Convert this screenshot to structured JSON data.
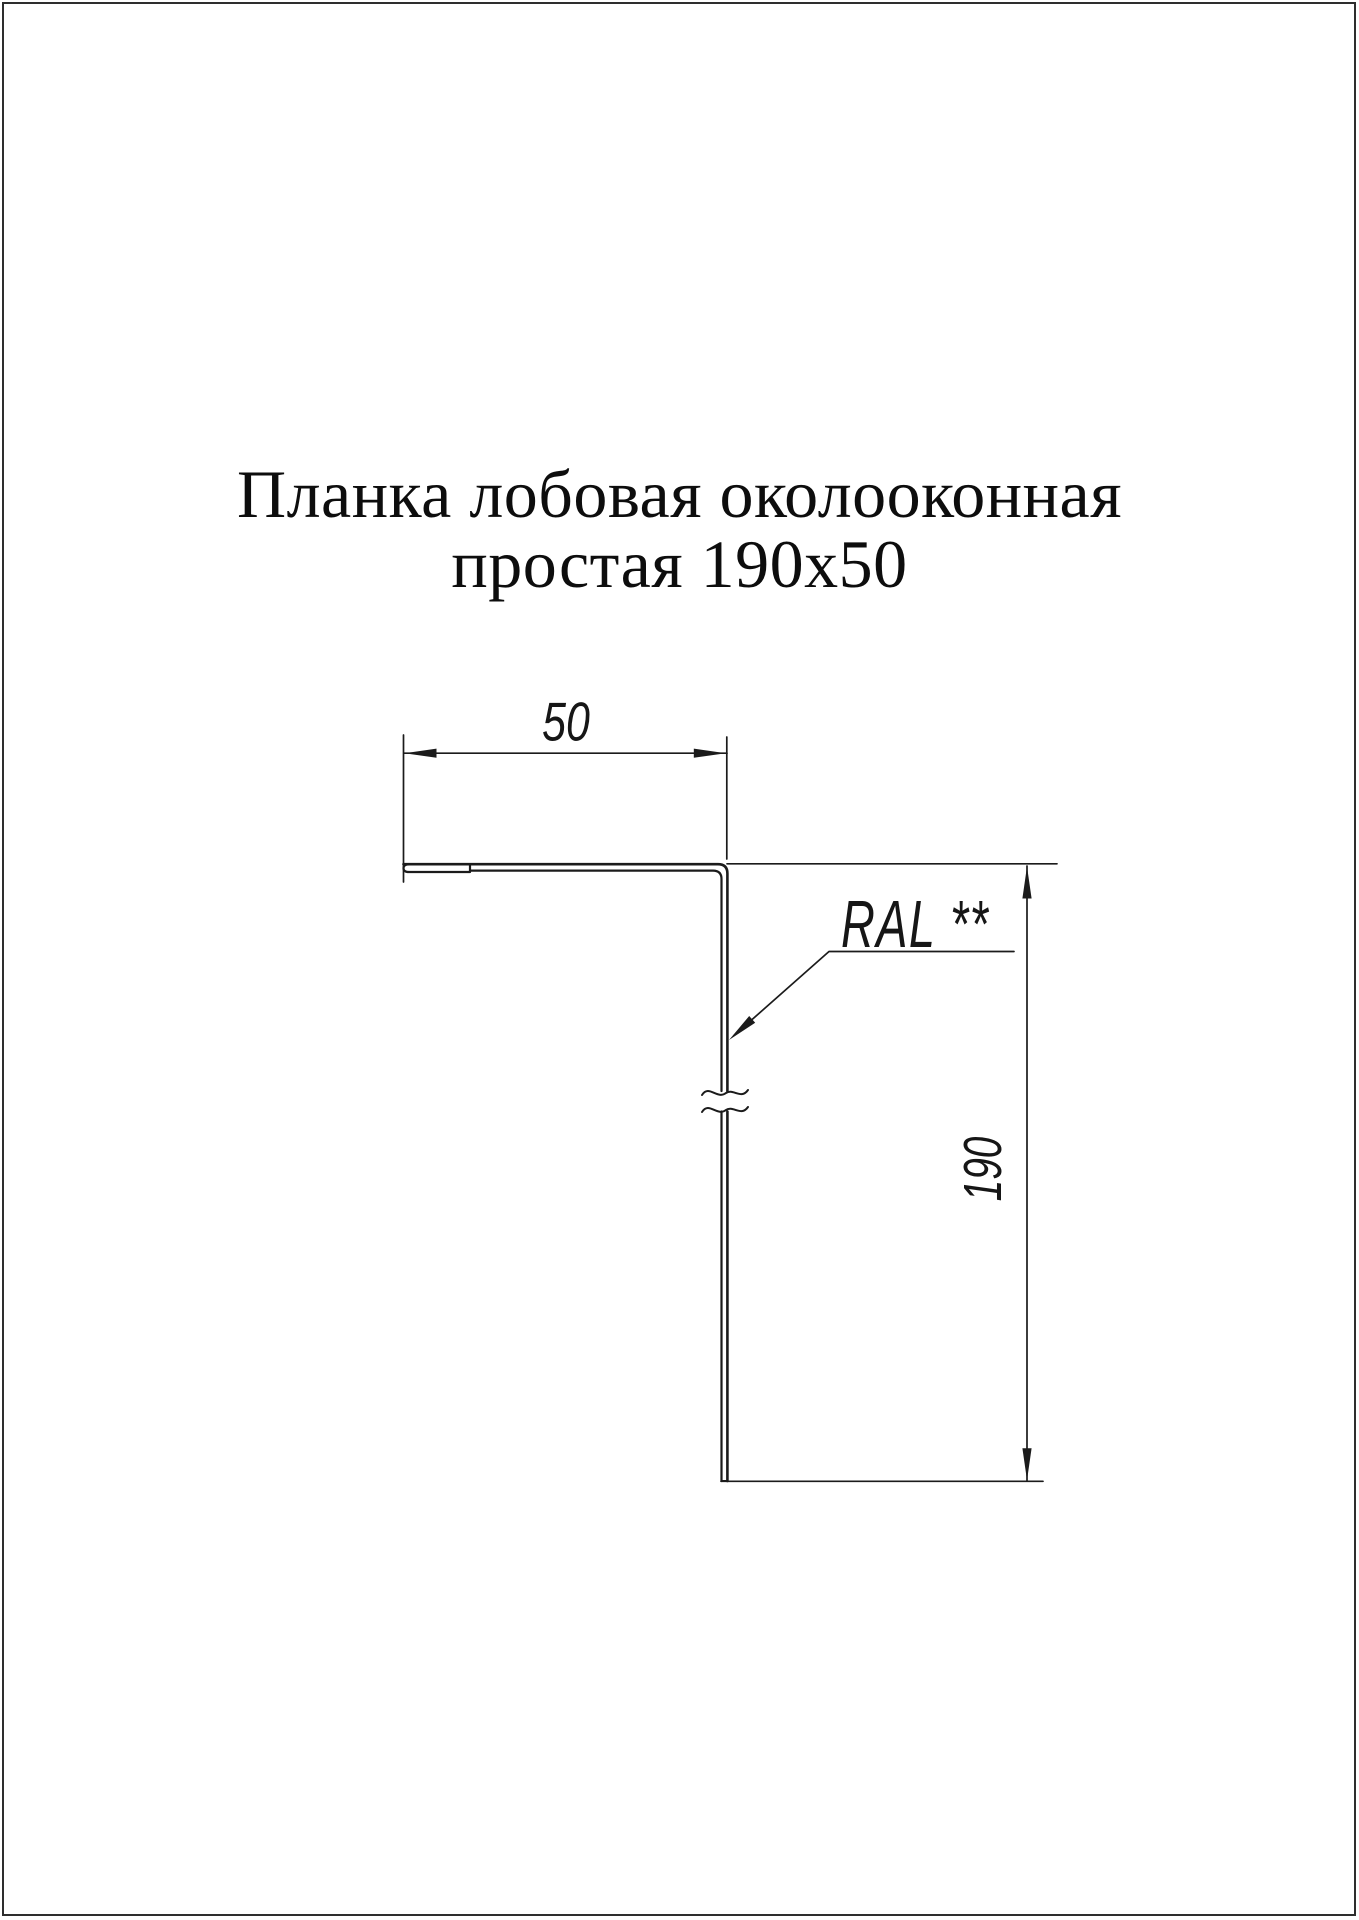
{
  "title": {
    "line1": "Планка лобовая околооконная",
    "line2": "простая 190x50"
  },
  "drawing": {
    "type": "profile-cross-section",
    "width_dim_label": "50",
    "height_dim_label": "190",
    "ral_label": "RAL **",
    "profile_width_mm": 50,
    "profile_height_mm": 190,
    "has_break_symbol": true,
    "has_hemmed_edge": true
  },
  "colors": {
    "background": "#ffffff",
    "line": "#1b1b1b",
    "text": "#0d0d0d",
    "page_border": "#2e2e2e"
  }
}
